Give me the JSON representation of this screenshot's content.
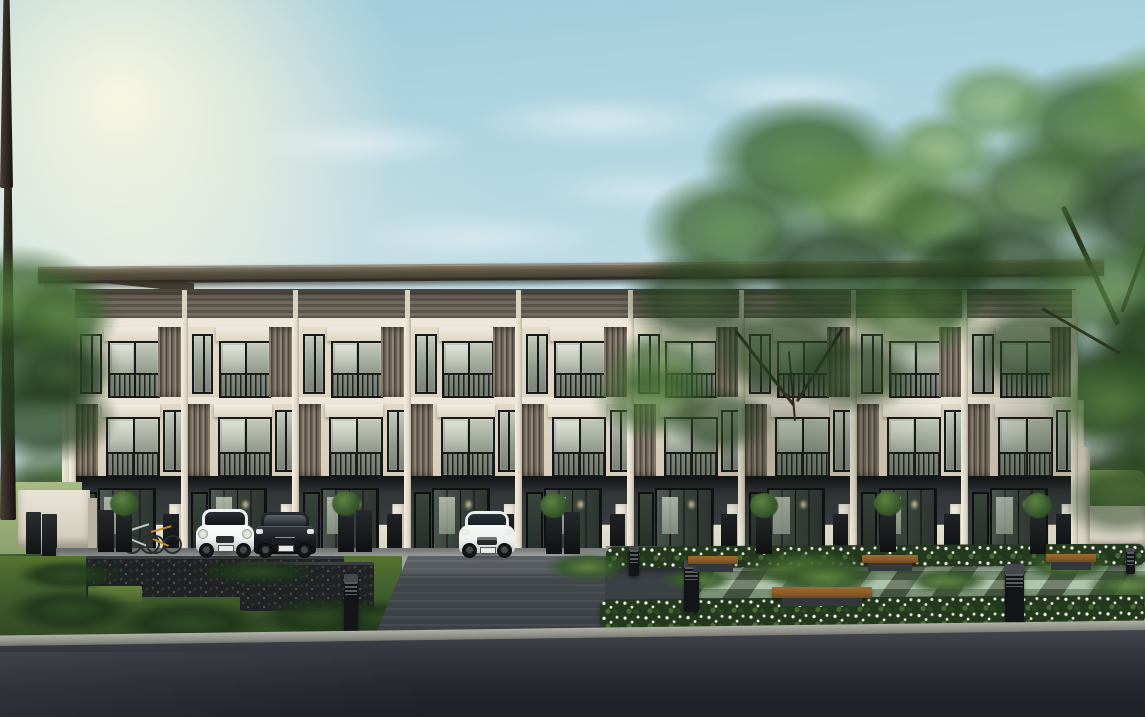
{
  "scene": {
    "caption": "Daytime architectural rendering of a modern three-storey townhome row with cream walls, timber louvre screens and dark roof; ground-floor carports with a white hatchback, black sedan, white SUV and bicycles; a landscaped front garden with white flower beds, wooden benches, black bollard lights and two large trees; a grey driveway, gabion stone wall, lawn and an asphalt road in the foreground under a soft blue sky with sun glow at the top left."
  },
  "palette": {
    "sky-top": "#9fcbdc",
    "sky-mid": "#c9e1e8",
    "sky-horizon": "#e9f1ee",
    "roof-hi": "#7f7668",
    "roof-lo": "#3f3931",
    "cler-a": "#716a5d",
    "cler-b": "#5a544a",
    "beam": "#ece7d8",
    "wall3": "#e4ddcb",
    "col": "#f2ecdd",
    "louv-a": "#8f8676",
    "louv-b": "#4e463b",
    "louv-c": "#6f675a",
    "frame": "#17181c",
    "glass-a": "#c3cabb",
    "glass-b": "#7b8377",
    "gnd-a": "#3e4245",
    "pave-a": "#a8aca9",
    "pave-b": "#b7bbb4",
    "gabion": "#202224",
    "grass-a": "#42602f",
    "grass-b": "#56742f",
    "drive-a": "#51575c",
    "drive-b": "#383d42",
    "asph-a": "#474c52",
    "asph-b": "#24272c",
    "curb": "#8c8e85",
    "flw-green": "#24381d",
    "paver-lt": "#a7c3a0",
    "paver-dk": "#57694e",
    "wood": "#8a5b28",
    "base": "#33383a",
    "bollard": "#131518",
    "trunk": "#2e2822",
    "hedge": "#6c8d52",
    "fence": "#e0dbcb",
    "mini": "#f4f6f5",
    "sedan": "#17191d",
    "suv": "#eff1ef",
    "bike1": "#c2c7c9",
    "bike2": "#c08a33",
    "glow": "#e5d9a8"
  },
  "sky": {
    "clouds": [
      {
        "x": 250,
        "y": 120,
        "w": 230,
        "h": 46,
        "o": 0.5
      },
      {
        "x": 470,
        "y": 95,
        "w": 260,
        "h": 52,
        "o": 0.55
      },
      {
        "x": 680,
        "y": 70,
        "w": 220,
        "h": 46,
        "o": 0.5
      },
      {
        "x": 860,
        "y": 170,
        "w": 300,
        "h": 60,
        "o": 0.6
      },
      {
        "x": 1010,
        "y": 120,
        "w": 220,
        "h": 44,
        "o": 0.5
      },
      {
        "x": 350,
        "y": 215,
        "w": 260,
        "h": 44,
        "o": 0.45
      },
      {
        "x": 600,
        "y": 255,
        "w": 240,
        "h": 40,
        "o": 0.45
      },
      {
        "x": 120,
        "y": 280,
        "w": 220,
        "h": 40,
        "o": 0.4
      },
      {
        "x": 830,
        "y": 250,
        "w": 200,
        "h": 36,
        "o": 0.5
      },
      {
        "x": 950,
        "y": 300,
        "w": 170,
        "h": 30,
        "o": 0.45
      },
      {
        "x": 540,
        "y": 170,
        "w": 200,
        "h": 40,
        "o": 0.4
      }
    ]
  },
  "building": {
    "name": "three-storey-townhome-row",
    "storeys": 3,
    "unit_count": 9,
    "left": 72,
    "width": 1004,
    "materials": [
      "cream plaster",
      "timber vertical louvres",
      "dark framed glazing",
      "dark grey carport base"
    ]
  },
  "vegetation": {
    "trees": [
      {
        "name": "corner-tree-left",
        "trunk": null,
        "branches": [],
        "blobs": [
          {
            "x": -70,
            "y": 245,
            "w": 180,
            "h": 120,
            "tone": "b",
            "o": 0.9
          },
          {
            "x": -50,
            "y": 310,
            "w": 170,
            "h": 110,
            "tone": "c",
            "o": 0.9
          },
          {
            "x": 0,
            "y": 275,
            "w": 120,
            "h": 85,
            "tone": "b",
            "o": 0.8
          },
          {
            "x": -30,
            "y": 370,
            "w": 150,
            "h": 95,
            "tone": "c",
            "o": 0.85
          },
          {
            "x": 10,
            "y": 340,
            "w": 100,
            "h": 70,
            "tone": "c",
            "o": 0.7
          }
        ]
      },
      {
        "name": "front-tree-left",
        "trunk": {
          "x": 790,
          "y": 392,
          "w": 13,
          "h": 188
        },
        "branches": [
          {
            "x": 794,
            "y": 404,
            "len": 95,
            "w": 3,
            "angle": -128
          },
          {
            "x": 797,
            "y": 400,
            "len": 85,
            "w": 3,
            "angle": -58
          },
          {
            "x": 795,
            "y": 420,
            "len": 70,
            "w": 2,
            "angle": -95
          }
        ],
        "blobs": [
          {
            "x": 700,
            "y": 95,
            "w": 210,
            "h": 130,
            "tone": "b",
            "o": 0.92
          },
          {
            "x": 780,
            "y": 140,
            "w": 190,
            "h": 120,
            "tone": "a",
            "o": 0.9
          },
          {
            "x": 640,
            "y": 170,
            "w": 180,
            "h": 120,
            "tone": "b",
            "o": 0.88
          },
          {
            "x": 860,
            "y": 170,
            "w": 160,
            "h": 110,
            "tone": "b",
            "o": 0.85
          },
          {
            "x": 740,
            "y": 210,
            "w": 190,
            "h": 130,
            "tone": "c",
            "o": 0.85
          },
          {
            "x": 620,
            "y": 250,
            "w": 150,
            "h": 100,
            "tone": "c",
            "o": 0.8
          },
          {
            "x": 840,
            "y": 260,
            "w": 150,
            "h": 100,
            "tone": "b",
            "o": 0.8
          },
          {
            "x": 700,
            "y": 300,
            "w": 160,
            "h": 100,
            "tone": "c",
            "o": 0.78
          },
          {
            "x": 790,
            "y": 330,
            "w": 130,
            "h": 85,
            "tone": "c",
            "o": 0.7
          },
          {
            "x": 600,
            "y": 330,
            "w": 120,
            "h": 80,
            "tone": "b",
            "o": 0.7
          },
          {
            "x": 880,
            "y": 110,
            "w": 120,
            "h": 80,
            "tone": "a",
            "o": 0.8
          },
          {
            "x": 590,
            "y": 360,
            "w": 130,
            "h": 80,
            "tone": "b",
            "o": 0.75
          },
          {
            "x": 665,
            "y": 385,
            "w": 110,
            "h": 70,
            "tone": "c",
            "o": 0.65
          },
          {
            "x": 905,
            "y": 230,
            "w": 100,
            "h": 70,
            "tone": "c",
            "o": 0.7
          }
        ]
      },
      {
        "name": "front-tree-right",
        "trunk": {
          "x": 1114,
          "y": 290,
          "w": 16,
          "h": 332
        },
        "branches": [
          {
            "x": 1118,
            "y": 322,
            "len": 130,
            "w": 5,
            "angle": -115
          },
          {
            "x": 1122,
            "y": 310,
            "len": 110,
            "w": 4,
            "angle": -70
          },
          {
            "x": 1120,
            "y": 352,
            "len": 90,
            "w": 3,
            "angle": -150
          }
        ],
        "blobs": [
          {
            "x": 1000,
            "y": 60,
            "w": 200,
            "h": 130,
            "tone": "b",
            "o": 0.9
          },
          {
            "x": 1080,
            "y": 40,
            "w": 180,
            "h": 120,
            "tone": "a",
            "o": 0.88
          },
          {
            "x": 950,
            "y": 130,
            "w": 190,
            "h": 120,
            "tone": "b",
            "o": 0.88
          },
          {
            "x": 1060,
            "y": 140,
            "w": 200,
            "h": 140,
            "tone": "c",
            "o": 0.88
          },
          {
            "x": 930,
            "y": 210,
            "w": 160,
            "h": 110,
            "tone": "c",
            "o": 0.8
          },
          {
            "x": 1020,
            "y": 230,
            "w": 180,
            "h": 120,
            "tone": "b",
            "o": 0.85
          },
          {
            "x": 1090,
            "y": 280,
            "w": 170,
            "h": 120,
            "tone": "c",
            "o": 0.85
          },
          {
            "x": 960,
            "y": 300,
            "w": 140,
            "h": 95,
            "tone": "c",
            "o": 0.75
          },
          {
            "x": 1040,
            "y": 350,
            "w": 150,
            "h": 100,
            "tone": "b",
            "o": 0.78
          },
          {
            "x": 1100,
            "y": 400,
            "w": 140,
            "h": 95,
            "tone": "c",
            "o": 0.75
          },
          {
            "x": 1060,
            "y": 460,
            "w": 120,
            "h": 80,
            "tone": "c",
            "o": 0.6
          },
          {
            "x": 930,
            "y": 60,
            "w": 130,
            "h": 85,
            "tone": "a",
            "o": 0.75
          },
          {
            "x": 1120,
            "y": 180,
            "w": 110,
            "h": 150,
            "tone": "b",
            "o": 0.8
          },
          {
            "x": 890,
            "y": 260,
            "w": 100,
            "h": 70,
            "tone": "c",
            "o": 0.6
          }
        ]
      }
    ],
    "background_clusters": [
      {
        "x": -25,
        "y": 455,
        "w": 150,
        "h": 100,
        "tone": "c",
        "o": 0.95
      },
      {
        "x": -40,
        "y": 510,
        "w": 160,
        "h": 90,
        "tone": "c",
        "o": 0.95
      },
      {
        "x": 30,
        "y": 500,
        "w": 115,
        "h": 85,
        "tone": "b",
        "o": 0.85
      },
      {
        "x": -10,
        "y": 545,
        "w": 130,
        "h": 60,
        "tone": "c",
        "o": 0.9
      },
      {
        "x": 40,
        "y": 450,
        "w": 90,
        "h": 70,
        "tone": "b",
        "o": 0.7
      },
      {
        "x": 0,
        "y": 430,
        "w": 130,
        "h": 80,
        "tone": "b",
        "o": 0.45
      },
      {
        "x": 1028,
        "y": 335,
        "w": 155,
        "h": 120,
        "tone": "c",
        "o": 0.95
      },
      {
        "x": 1085,
        "y": 295,
        "w": 150,
        "h": 130,
        "tone": "c",
        "o": 0.9
      },
      {
        "x": 1045,
        "y": 435,
        "w": 155,
        "h": 110,
        "tone": "c",
        "o": 0.95
      },
      {
        "x": 1105,
        "y": 415,
        "w": 135,
        "h": 100,
        "tone": "b",
        "o": 0.85
      },
      {
        "x": 1028,
        "y": 515,
        "w": 135,
        "h": 75,
        "tone": "c",
        "o": 0.9
      },
      {
        "x": 1108,
        "y": 495,
        "w": 115,
        "h": 80,
        "tone": "c",
        "o": 0.85
      }
    ],
    "grass_tufts": [
      {
        "x": 5,
        "y": 588,
        "w": 130,
        "h": 44,
        "t": "d"
      },
      {
        "x": 115,
        "y": 600,
        "w": 150,
        "h": 46,
        "t": "d"
      },
      {
        "x": 255,
        "y": 596,
        "w": 140,
        "h": 42,
        "t": "d"
      },
      {
        "x": 15,
        "y": 560,
        "w": 110,
        "h": 30,
        "t": "d"
      },
      {
        "x": 195,
        "y": 558,
        "w": 125,
        "h": 28,
        "t": "d"
      },
      {
        "x": 325,
        "y": 600,
        "w": 115,
        "h": 38,
        "t": "d"
      },
      {
        "x": 545,
        "y": 552,
        "w": 85,
        "h": 30,
        "t": "l"
      },
      {
        "x": 740,
        "y": 550,
        "w": 130,
        "h": 38,
        "t": "l"
      },
      {
        "x": 1020,
        "y": 550,
        "w": 95,
        "h": 30,
        "t": "l"
      },
      {
        "x": 660,
        "y": 568,
        "w": 75,
        "h": 24,
        "t": "l"
      },
      {
        "x": 905,
        "y": 568,
        "w": 85,
        "h": 26,
        "t": "l"
      },
      {
        "x": 1085,
        "y": 572,
        "w": 85,
        "h": 28,
        "t": "l"
      },
      {
        "x": 770,
        "y": 560,
        "w": 110,
        "h": 34,
        "t": "l"
      }
    ]
  },
  "street": {
    "planters": [
      {
        "x": 98,
        "y": 510,
        "shrub": false
      },
      {
        "x": 116,
        "y": 510,
        "shrub": true
      },
      {
        "x": 338,
        "y": 510,
        "shrub": true
      },
      {
        "x": 356,
        "y": 510,
        "shrub": false
      },
      {
        "x": 546,
        "y": 512,
        "shrub": true
      },
      {
        "x": 564,
        "y": 512,
        "shrub": false
      },
      {
        "x": 756,
        "y": 512,
        "shrub": true
      },
      {
        "x": 880,
        "y": 510,
        "shrub": true
      },
      {
        "x": 1030,
        "y": 512,
        "shrub": true
      }
    ],
    "bollards": [
      {
        "x": 344,
        "y": 574,
        "w": 14,
        "h": 58
      },
      {
        "x": 629,
        "y": 546,
        "w": 10,
        "h": 30
      },
      {
        "x": 684,
        "y": 560,
        "w": 15,
        "h": 52
      },
      {
        "x": 1005,
        "y": 564,
        "w": 19,
        "h": 70
      },
      {
        "x": 1126,
        "y": 548,
        "w": 9,
        "h": 26
      }
    ],
    "benches": [
      {
        "x": 688,
        "y": 556,
        "w": 50,
        "h": 8
      },
      {
        "x": 862,
        "y": 555,
        "w": 56,
        "h": 8
      },
      {
        "x": 1046,
        "y": 554,
        "w": 50,
        "h": 8
      },
      {
        "x": 772,
        "y": 587,
        "w": 100,
        "h": 11
      }
    ]
  },
  "vehicles": [
    {
      "name": "white-mini-hatchback",
      "body_color": "#f4f6f5"
    },
    {
      "name": "black-sedan",
      "body_color": "#17191d"
    },
    {
      "name": "white-suv",
      "body_color": "#eff1ef"
    }
  ],
  "bicycles": [
    {
      "name": "silver-bicycle",
      "color": "#c2c7c9"
    },
    {
      "name": "orange-bicycle",
      "color": "#c08a33"
    }
  ]
}
